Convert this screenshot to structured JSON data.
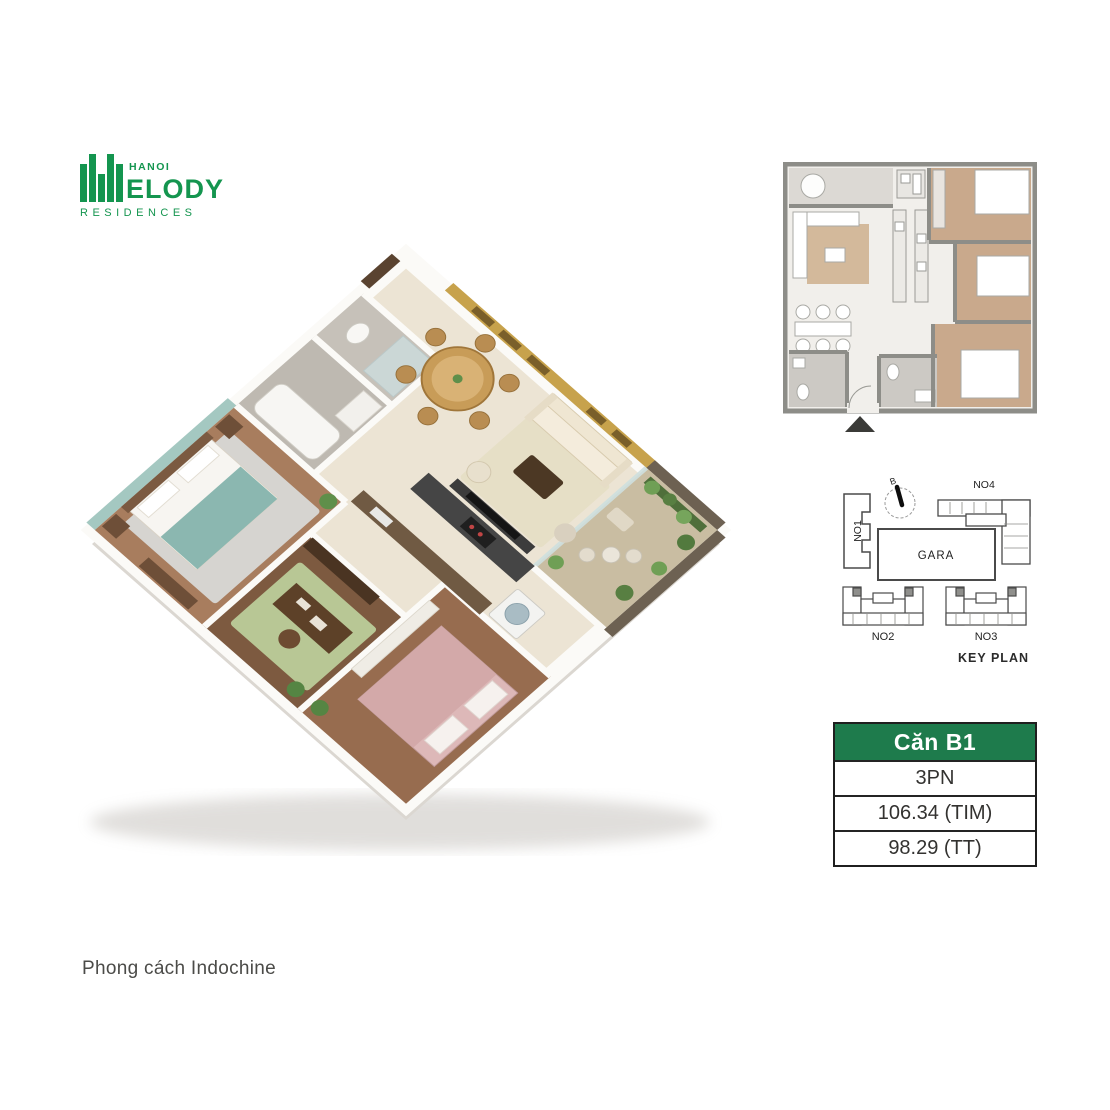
{
  "brand": {
    "name_line1": "HANOI",
    "name_line2": "ELODY",
    "name_line3": "RESIDENCES",
    "green": "#14954F"
  },
  "caption": "Phong cách Indochine",
  "key_plan": {
    "title": "KEY PLAN",
    "compass": "B",
    "garage": "GARA",
    "no1": "NO1",
    "no2": "NO2",
    "no3": "NO3",
    "no4": "NO4"
  },
  "unit_info": {
    "name": "Căn B1",
    "bedrooms": "3PN",
    "area_tim": "106.34 (TIM)",
    "area_tt": "98.29 (TT)",
    "header_bg": "#1E7B4C"
  }
}
